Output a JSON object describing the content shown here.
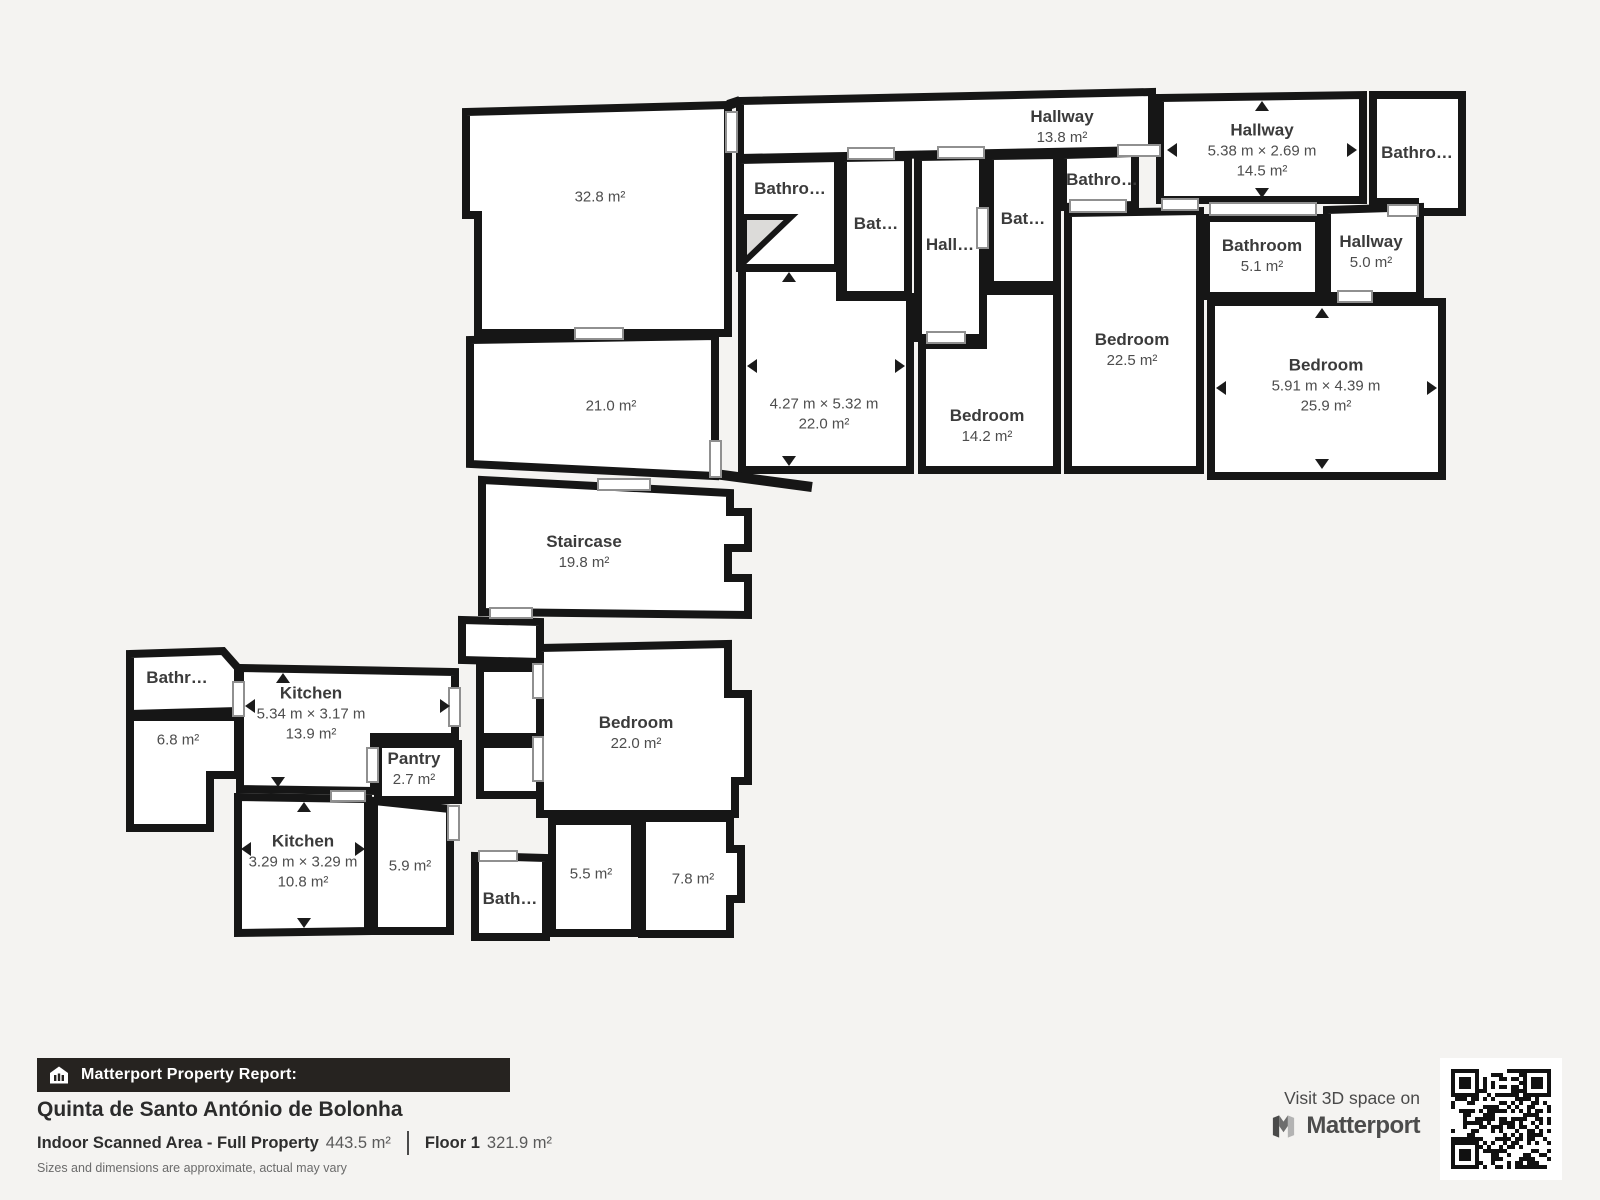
{
  "colors": {
    "background": "#f4f3f1",
    "wall": "#161616",
    "room_fill": "#ffffff",
    "door_outline": "#909090",
    "label_text": "#3b3b3b",
    "footer_bar_bg": "#262320",
    "footer_bar_text": "#ffffff"
  },
  "floorplan": {
    "rooms": [
      {
        "id": "hallway-top",
        "name": "Hallway",
        "area": "13.8 m²"
      },
      {
        "id": "hallway-main",
        "name": "Hallway",
        "dims": "5.38 m × 2.69 m",
        "area": "14.5 m²"
      },
      {
        "id": "bathroom-far",
        "name": "Bathro…"
      },
      {
        "id": "bathroom-a",
        "name": "Bathro…"
      },
      {
        "id": "bathroom-b",
        "name": "Bat…"
      },
      {
        "id": "hall-small",
        "name": "Hall…"
      },
      {
        "id": "bathroom-c",
        "name": "Bat…"
      },
      {
        "id": "bathroom-d",
        "name": "Bathro…"
      },
      {
        "id": "bathroom-51",
        "name": "Bathroom",
        "area": "5.1 m²"
      },
      {
        "id": "hallway-50",
        "name": "Hallway",
        "area": "5.0 m²"
      },
      {
        "id": "room-328",
        "area": "32.8 m²"
      },
      {
        "id": "room-210",
        "area": "21.0 m²"
      },
      {
        "id": "room-220a",
        "dims": "4.27 m × 5.32 m",
        "area": "22.0 m²"
      },
      {
        "id": "bedroom-142",
        "name": "Bedroom",
        "area": "14.2 m²"
      },
      {
        "id": "bedroom-225",
        "name": "Bedroom",
        "area": "22.5 m²"
      },
      {
        "id": "bedroom-259",
        "name": "Bedroom",
        "dims": "5.91 m × 4.39 m",
        "area": "25.9 m²"
      },
      {
        "id": "staircase",
        "name": "Staircase",
        "area": "19.8 m²"
      },
      {
        "id": "bathroom-left",
        "name": "Bathr…"
      },
      {
        "id": "room-68",
        "area": "6.8 m²"
      },
      {
        "id": "kitchen-139",
        "name": "Kitchen",
        "dims": "5.34 m × 3.17 m",
        "area": "13.9 m²"
      },
      {
        "id": "pantry",
        "name": "Pantry",
        "area": "2.7 m²"
      },
      {
        "id": "kitchen-108",
        "name": "Kitchen",
        "dims": "3.29 m × 3.29 m",
        "area": "10.8 m²"
      },
      {
        "id": "room-59",
        "area": "5.9 m²"
      },
      {
        "id": "bathroom-small",
        "name": "Bath…"
      },
      {
        "id": "bedroom-220b",
        "name": "Bedroom",
        "area": "22.0 m²"
      },
      {
        "id": "room-55",
        "area": "5.5 m²"
      },
      {
        "id": "room-78",
        "area": "7.8 m²"
      }
    ]
  },
  "footer": {
    "report_label": "Matterport Property Report:",
    "property_name": "Quinta de Santo António de Bolonha",
    "scanned_area_label": "Indoor Scanned Area - Full Property",
    "scanned_area_value": "443.5 m²",
    "floor_label": "Floor 1",
    "floor_value": "321.9 m²",
    "disclaimer": "Sizes and dimensions are approximate, actual may vary"
  },
  "promo": {
    "visit_text": "Visit 3D space on",
    "brand": "Matterport"
  }
}
